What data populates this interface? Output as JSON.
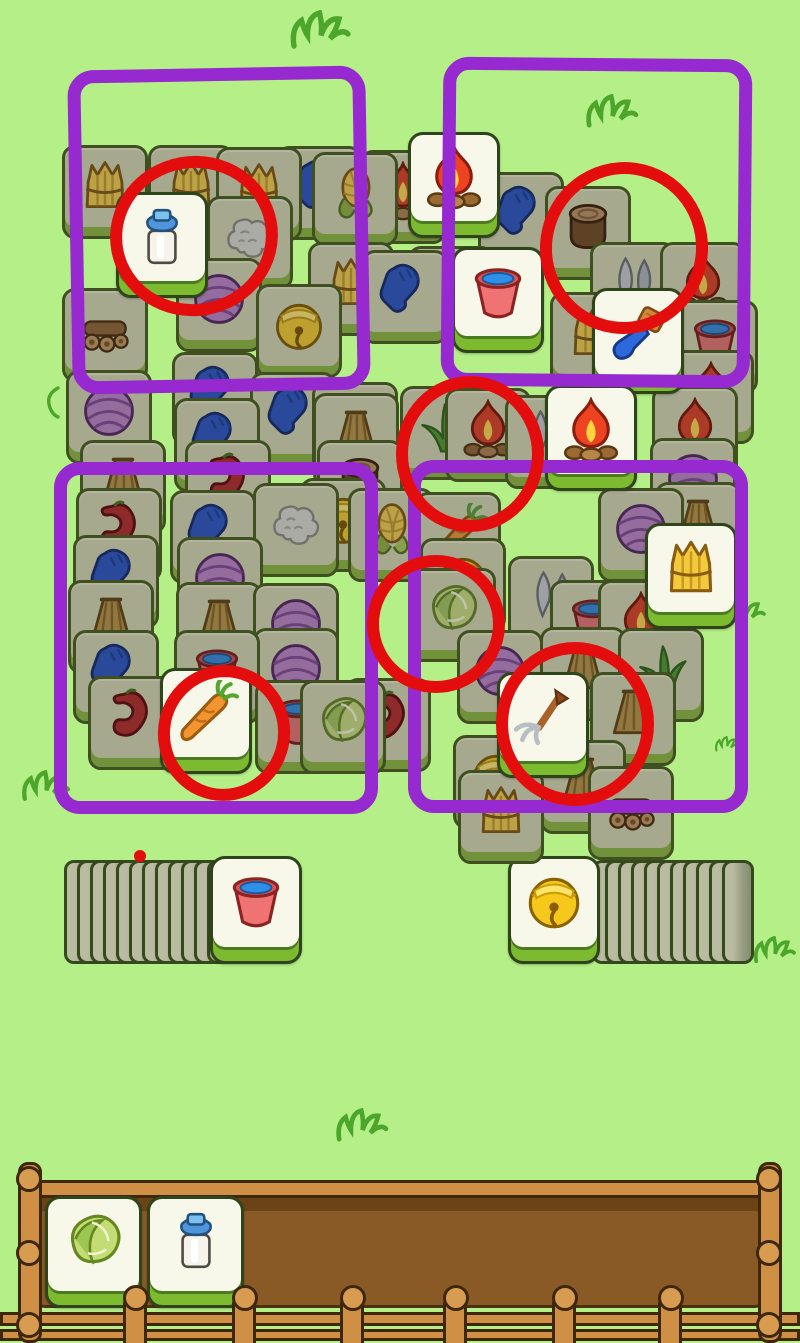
{
  "game": {
    "name": "tile-match-puzzle",
    "visible_text": "",
    "tile_kinds": [
      "hay",
      "corn",
      "straw",
      "yarn",
      "wool",
      "glove",
      "fire",
      "milk",
      "bucket",
      "stump",
      "knives",
      "brush",
      "bell",
      "pepper",
      "carrot",
      "cabbage",
      "grass",
      "pitchfork",
      "logs"
    ]
  },
  "colors": {
    "background": "#b5ef88",
    "tile_dark_face": "#a6a98e",
    "tile_dark_bottom": "#72913b",
    "tile_bright_face": "#f7f8e9",
    "tile_bright_bottom": "#7cba30",
    "tile_border": "#3f4f20",
    "marker_purple": "#9629cf",
    "marker_red": "#e40d0d",
    "wood_light": "#cf8f45",
    "wood_dark_interior": "#8a5a26",
    "grass_decor": "#4ca62c"
  },
  "board": {
    "tiles": [
      {
        "x": 408,
        "y": 132,
        "icon": "fire",
        "state": "bright"
      },
      {
        "x": 62,
        "y": 145,
        "icon": "hay",
        "state": "dark"
      },
      {
        "x": 148,
        "y": 145,
        "icon": "hay",
        "state": "dark"
      },
      {
        "x": 276,
        "y": 146,
        "icon": "glove",
        "state": "dark"
      },
      {
        "x": 216,
        "y": 147,
        "icon": "hay",
        "state": "dark"
      },
      {
        "x": 360,
        "y": 150,
        "icon": "fire",
        "state": "dark"
      },
      {
        "x": 312,
        "y": 152,
        "icon": "corn",
        "state": "dark"
      },
      {
        "x": 478,
        "y": 172,
        "icon": "glove",
        "state": "dark"
      },
      {
        "x": 545,
        "y": 186,
        "icon": "stump",
        "state": "dark"
      },
      {
        "x": 116,
        "y": 192,
        "icon": "milk",
        "state": "bright"
      },
      {
        "x": 207,
        "y": 196,
        "icon": "wool",
        "state": "dark"
      },
      {
        "x": 308,
        "y": 242,
        "icon": "hay",
        "state": "dark"
      },
      {
        "x": 590,
        "y": 242,
        "icon": "knives",
        "state": "dark"
      },
      {
        "x": 660,
        "y": 242,
        "icon": "fire",
        "state": "dark"
      },
      {
        "x": 408,
        "y": 246,
        "icon": "hay",
        "state": "dark"
      },
      {
        "x": 452,
        "y": 247,
        "icon": "bucket",
        "state": "bright"
      },
      {
        "x": 362,
        "y": 250,
        "icon": "glove",
        "state": "dark"
      },
      {
        "x": 176,
        "y": 258,
        "icon": "yarn",
        "state": "dark"
      },
      {
        "x": 256,
        "y": 284,
        "icon": "bell",
        "state": "dark"
      },
      {
        "x": 62,
        "y": 288,
        "icon": "logs",
        "state": "dark"
      },
      {
        "x": 592,
        "y": 288,
        "icon": "brush",
        "state": "bright"
      },
      {
        "x": 550,
        "y": 292,
        "icon": "hay",
        "state": "dark"
      },
      {
        "x": 672,
        "y": 300,
        "icon": "bucket",
        "state": "dark"
      },
      {
        "x": 668,
        "y": 350,
        "icon": "fire",
        "state": "dark"
      },
      {
        "x": 172,
        "y": 352,
        "icon": "glove",
        "state": "dark"
      },
      {
        "x": 66,
        "y": 370,
        "icon": "yarn",
        "state": "dark"
      },
      {
        "x": 250,
        "y": 372,
        "icon": "glove",
        "state": "dark"
      },
      {
        "x": 312,
        "y": 382,
        "icon": "glove",
        "state": "dark"
      },
      {
        "x": 545,
        "y": 385,
        "icon": "fire",
        "state": "bright"
      },
      {
        "x": 652,
        "y": 386,
        "icon": "fire",
        "state": "dark"
      },
      {
        "x": 400,
        "y": 386,
        "icon": "grass",
        "state": "dark"
      },
      {
        "x": 445,
        "y": 388,
        "icon": "fire",
        "state": "dark"
      },
      {
        "x": 313,
        "y": 393,
        "icon": "straw",
        "state": "dark"
      },
      {
        "x": 505,
        "y": 395,
        "icon": "knives",
        "state": "dark"
      },
      {
        "x": 174,
        "y": 398,
        "icon": "glove",
        "state": "dark"
      },
      {
        "x": 650,
        "y": 438,
        "icon": "yarn",
        "state": "dark"
      },
      {
        "x": 80,
        "y": 440,
        "icon": "straw",
        "state": "dark"
      },
      {
        "x": 185,
        "y": 440,
        "icon": "pepper",
        "state": "dark"
      },
      {
        "x": 317,
        "y": 440,
        "icon": "stump",
        "state": "dark"
      },
      {
        "x": 300,
        "y": 478,
        "icon": "bell",
        "state": "dark"
      },
      {
        "x": 655,
        "y": 482,
        "icon": "straw",
        "state": "dark"
      },
      {
        "x": 253,
        "y": 483,
        "icon": "wool",
        "state": "dark"
      },
      {
        "x": 76,
        "y": 488,
        "icon": "pepper",
        "state": "dark"
      },
      {
        "x": 348,
        "y": 488,
        "icon": "corn",
        "state": "dark"
      },
      {
        "x": 598,
        "y": 488,
        "icon": "yarn",
        "state": "dark"
      },
      {
        "x": 170,
        "y": 490,
        "icon": "glove",
        "state": "dark"
      },
      {
        "x": 415,
        "y": 492,
        "icon": "carrot",
        "state": "dark"
      },
      {
        "x": 645,
        "y": 523,
        "icon": "hay",
        "state": "bright"
      },
      {
        "x": 73,
        "y": 535,
        "icon": "glove",
        "state": "dark"
      },
      {
        "x": 177,
        "y": 537,
        "icon": "yarn",
        "state": "dark"
      },
      {
        "x": 420,
        "y": 538,
        "icon": "bell",
        "state": "dark"
      },
      {
        "x": 508,
        "y": 556,
        "icon": "knives",
        "state": "dark"
      },
      {
        "x": 410,
        "y": 568,
        "icon": "cabbage",
        "state": "dark"
      },
      {
        "x": 68,
        "y": 580,
        "icon": "straw",
        "state": "dark"
      },
      {
        "x": 550,
        "y": 580,
        "icon": "bucket",
        "state": "dark"
      },
      {
        "x": 598,
        "y": 580,
        "icon": "fire",
        "state": "dark"
      },
      {
        "x": 176,
        "y": 582,
        "icon": "straw",
        "state": "dark"
      },
      {
        "x": 253,
        "y": 583,
        "icon": "yarn",
        "state": "dark"
      },
      {
        "x": 540,
        "y": 627,
        "icon": "straw",
        "state": "dark"
      },
      {
        "x": 253,
        "y": 628,
        "icon": "yarn",
        "state": "dark"
      },
      {
        "x": 618,
        "y": 628,
        "icon": "grass",
        "state": "dark"
      },
      {
        "x": 73,
        "y": 630,
        "icon": "glove",
        "state": "dark"
      },
      {
        "x": 174,
        "y": 630,
        "icon": "bucket",
        "state": "dark"
      },
      {
        "x": 457,
        "y": 630,
        "icon": "yarn",
        "state": "dark"
      },
      {
        "x": 160,
        "y": 668,
        "icon": "carrot",
        "state": "bright"
      },
      {
        "x": 497,
        "y": 672,
        "icon": "pitchfork",
        "state": "bright"
      },
      {
        "x": 590,
        "y": 672,
        "icon": "straw",
        "state": "dark"
      },
      {
        "x": 88,
        "y": 676,
        "icon": "pepper",
        "state": "dark"
      },
      {
        "x": 345,
        "y": 678,
        "icon": "pepper",
        "state": "dark"
      },
      {
        "x": 255,
        "y": 680,
        "icon": "bucket",
        "state": "dark"
      },
      {
        "x": 300,
        "y": 680,
        "icon": "cabbage",
        "state": "dark"
      },
      {
        "x": 453,
        "y": 735,
        "icon": "bell",
        "state": "dark"
      },
      {
        "x": 540,
        "y": 740,
        "icon": "straw",
        "state": "dark"
      },
      {
        "x": 588,
        "y": 766,
        "icon": "logs",
        "state": "dark"
      },
      {
        "x": 458,
        "y": 770,
        "icon": "hay",
        "state": "dark"
      }
    ]
  },
  "annotations": {
    "purple_rects": [
      {
        "x": 70,
        "y": 68,
        "w": 272,
        "h": 298,
        "rot": -1
      },
      {
        "x": 442,
        "y": 58,
        "w": 283,
        "h": 303,
        "rot": 0.5
      },
      {
        "x": 54,
        "y": 462,
        "w": 298,
        "h": 326,
        "rot": 0
      },
      {
        "x": 408,
        "y": 460,
        "w": 314,
        "h": 327,
        "rot": 0
      }
    ],
    "red_circles": [
      {
        "cx": 182,
        "cy": 224,
        "rx": 72,
        "ry": 68,
        "rot": -10
      },
      {
        "cx": 612,
        "cy": 236,
        "rx": 72,
        "ry": 74,
        "rot": 8
      },
      {
        "cx": 458,
        "cy": 442,
        "rx": 62,
        "ry": 66,
        "rot": 0
      },
      {
        "cx": 424,
        "cy": 612,
        "rx": 57,
        "ry": 57,
        "rot": 0
      },
      {
        "cx": 212,
        "cy": 721,
        "rx": 54,
        "ry": 56,
        "rot": 12
      },
      {
        "cx": 563,
        "cy": 712,
        "rx": 67,
        "ry": 70,
        "rot": 0
      }
    ],
    "red_dot": {
      "cx": 140,
      "cy": 856,
      "r": 6
    }
  },
  "stacks": {
    "left": {
      "ribs": 12,
      "rib_x": 64,
      "rib_y": 860,
      "rib_step": 13,
      "face_icon": "bucket",
      "face_x": 210,
      "face_y": 856
    },
    "right": {
      "ribs": 11,
      "rib_x": 592,
      "rib_y": 860,
      "rib_step": 13,
      "face_icon": "bell",
      "face_x": 508,
      "face_y": 856
    }
  },
  "tray": {
    "tiles": [
      {
        "icon": "cabbage",
        "x": 45,
        "y": 1196
      },
      {
        "icon": "milk",
        "x": 147,
        "y": 1196
      }
    ],
    "interior": {
      "x": 30,
      "y": 1192,
      "w": 740,
      "h": 116
    },
    "top_rail": {
      "x": 26,
      "y": 1180,
      "w": 748,
      "h": 18
    },
    "left_post": {
      "x": 18,
      "y": 1162,
      "w": 24,
      "h": 181
    },
    "right_post": {
      "x": 758,
      "y": 1162,
      "w": 24,
      "h": 181
    },
    "post_knobs_y": [
      1166,
      1240,
      1312
    ],
    "fence_rails": [
      {
        "x": 0,
        "y": 1312,
        "w": 800,
        "h": 14
      },
      {
        "x": 0,
        "y": 1329,
        "w": 800,
        "h": 12
      }
    ],
    "fence_posts_x": [
      123,
      232,
      340,
      443,
      552,
      658
    ],
    "fence_posts_y": 1296
  },
  "decor": {
    "tufts": [
      {
        "x": 288,
        "y": 10,
        "s": 1.5
      },
      {
        "x": 584,
        "y": 94,
        "s": 1.3
      },
      {
        "x": 20,
        "y": 770,
        "s": 1.2
      },
      {
        "x": 724,
        "y": 598,
        "s": 1.0
      },
      {
        "x": 752,
        "y": 936,
        "s": 1.05
      },
      {
        "x": 334,
        "y": 1108,
        "s": 1.3
      },
      {
        "x": 714,
        "y": 736,
        "s": 0.6
      }
    ],
    "curls": [
      {
        "x": 44,
        "y": 386,
        "s": 1.0
      }
    ]
  }
}
